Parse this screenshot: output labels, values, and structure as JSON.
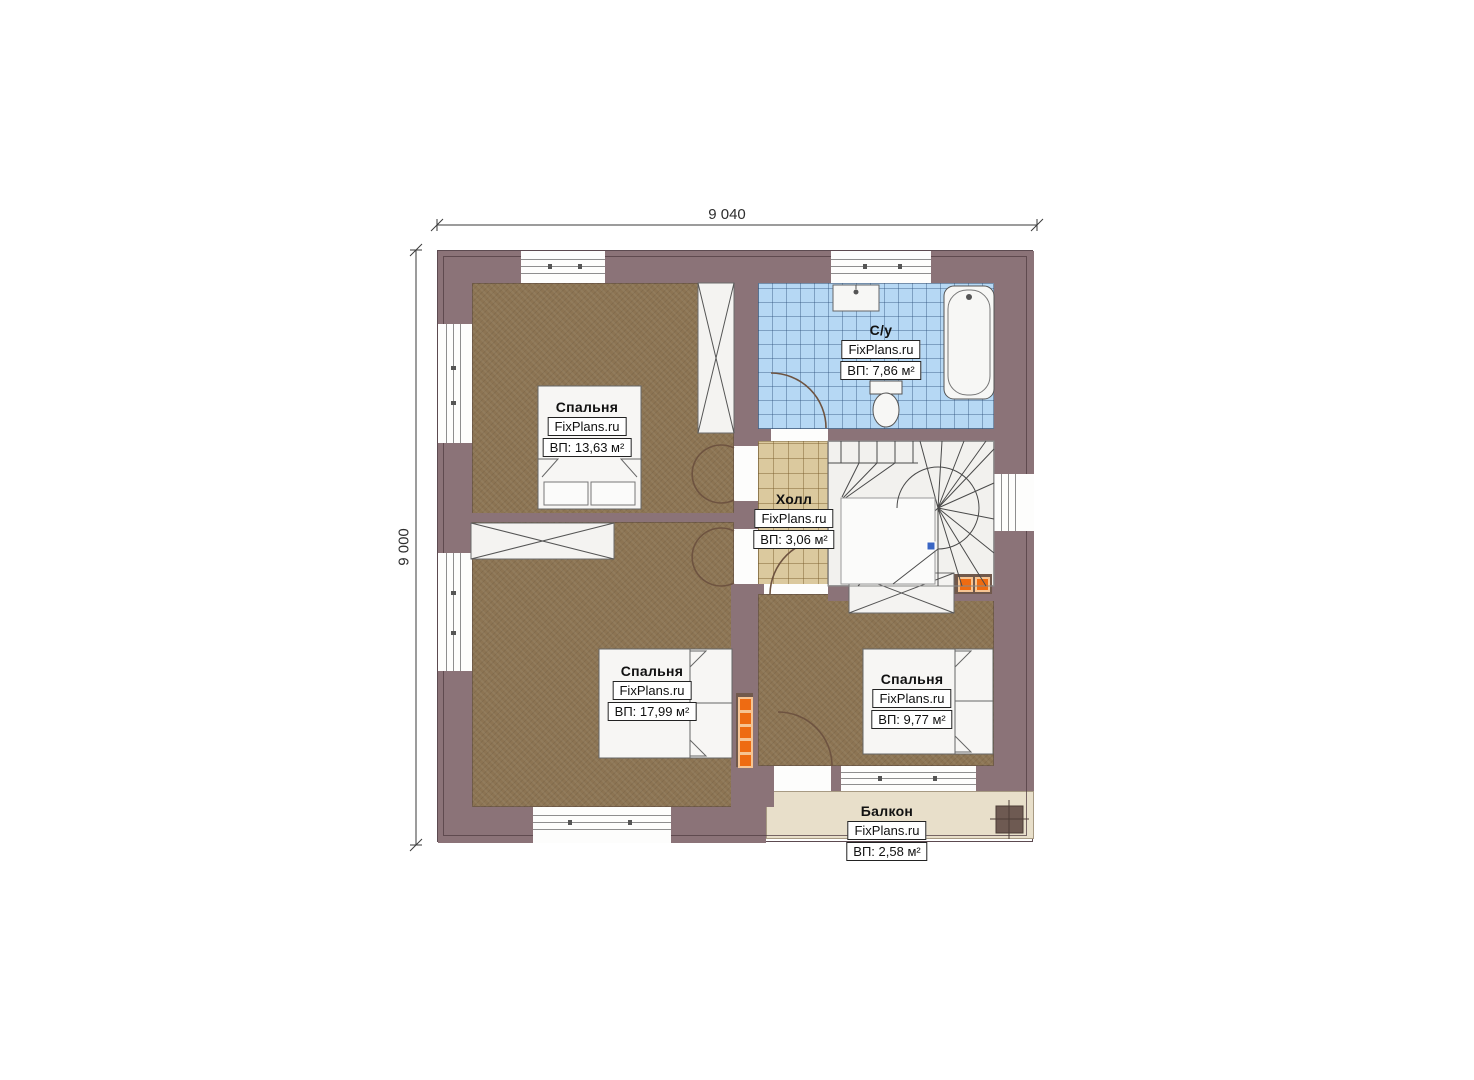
{
  "drawing": {
    "type": "floor-plan",
    "dimensions": {
      "top": "9 040",
      "left": "9 000"
    }
  },
  "rooms": {
    "bedroom_top_left": {
      "name": "Спальня",
      "brand": "FixPlans.ru",
      "area": "ВП: 13,63 м²"
    },
    "bathroom": {
      "name": "С/у",
      "brand": "FixPlans.ru",
      "area": "ВП: 7,86 м²"
    },
    "hall": {
      "name": "Холл",
      "brand": "FixPlans.ru",
      "area": "ВП: 3,06 м²"
    },
    "bedroom_bottom_left": {
      "name": "Спальня",
      "brand": "FixPlans.ru",
      "area": "ВП: 17,99 м²"
    },
    "bedroom_bottom_right": {
      "name": "Спальня",
      "brand": "FixPlans.ru",
      "area": "ВП: 9,77 м²"
    },
    "balcony": {
      "name": "Балкон",
      "brand": "FixPlans.ru",
      "area": "ВП: 2,58 м²"
    }
  },
  "colors": {
    "wall": "#8b7378",
    "bedroom_floor": "#8c7453",
    "bathroom_tile": "#b6d8f4",
    "hall_tile": "#dbc99e",
    "balcony_floor": "#e8dfca",
    "stairs_floor": "#f2f1ee",
    "vent_orange": "#ee6b12",
    "stair_marker_blue": "#3a66c4"
  }
}
